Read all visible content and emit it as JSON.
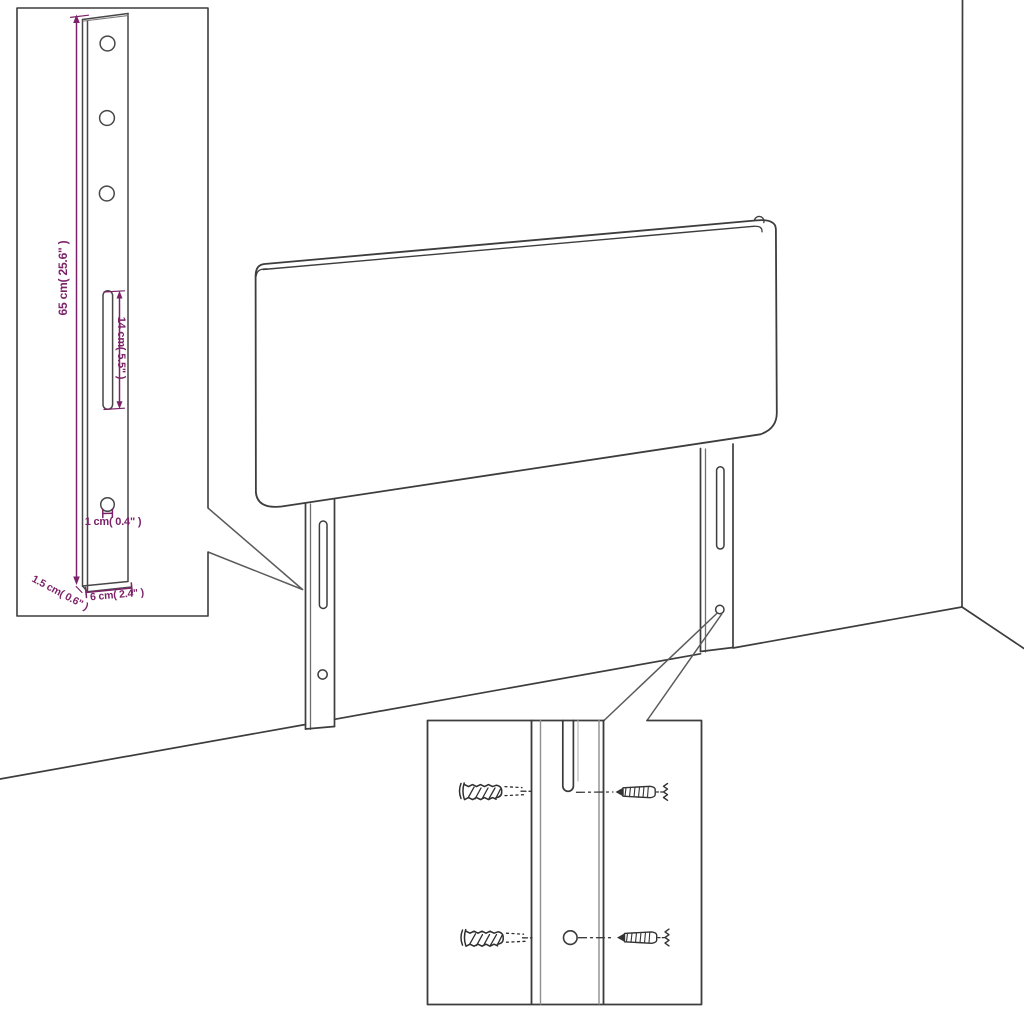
{
  "diagram": {
    "kind": "headboard-dimension-diagram",
    "accent_color": "#7b2268",
    "line_color": "#3d3d3d",
    "dimensions": {
      "bracket_height": "65 cm( 25.6\" )",
      "slot_length": "14 cm( 5.5\" )",
      "hole_diameter": "1 cm( 0.4\" )",
      "bracket_thickness": "1.5 cm( 0.6\" )",
      "bracket_width": "6 cm( 2.4\" )"
    }
  }
}
